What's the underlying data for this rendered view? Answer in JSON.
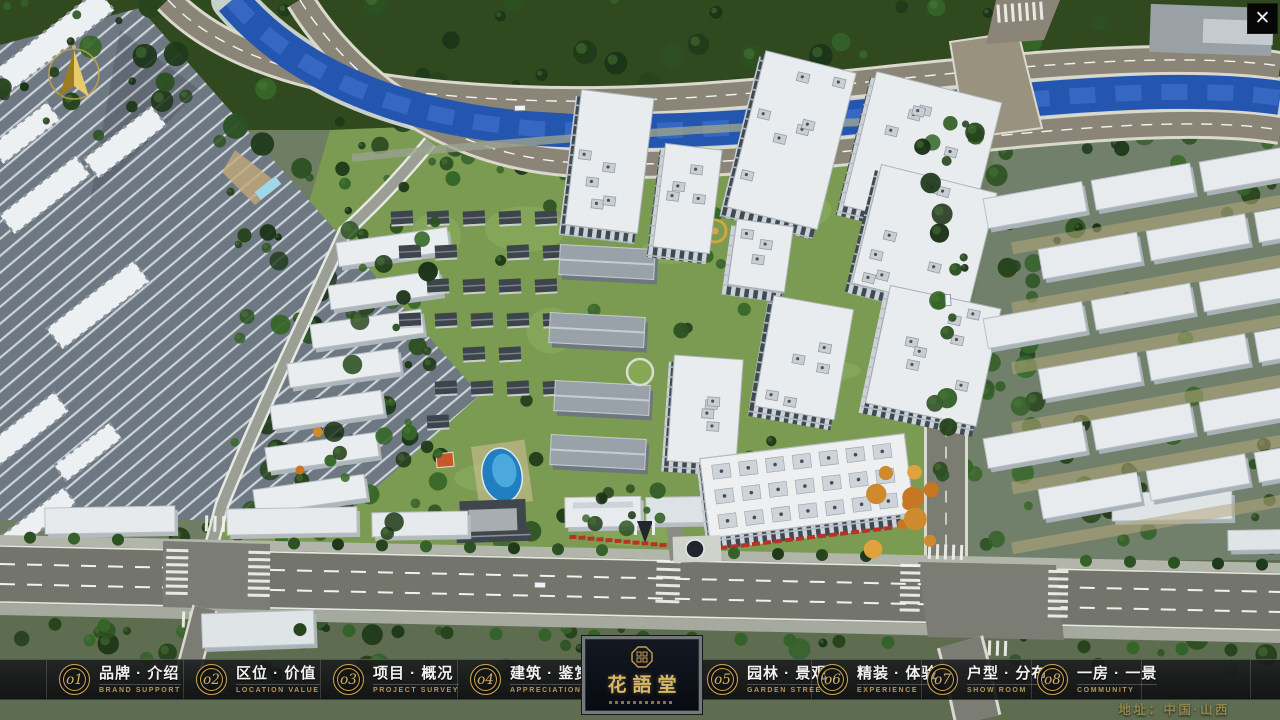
{
  "app": {
    "close_glyph": "✕"
  },
  "icons": {
    "close": "close-icon",
    "compass": "compass-north-arrow-icon",
    "logo_seal": "seal-emblem-icon"
  },
  "nav": {
    "items": [
      {
        "num": "o1",
        "title": "品牌 · 介绍",
        "subtitle": "BRAND SUPPORT"
      },
      {
        "num": "o2",
        "title": "区位 · 价值",
        "subtitle": "LOCATION VALUE"
      },
      {
        "num": "o3",
        "title": "项目 · 概况",
        "subtitle": "PROJECT SURVEY"
      },
      {
        "num": "o4",
        "title": "建筑 · 鉴赏",
        "subtitle": "APPRECIATION"
      },
      {
        "num": "o5",
        "title": "园林 · 景观",
        "subtitle": "GARDEN STREET"
      },
      {
        "num": "o6",
        "title": "精装 · 体验",
        "subtitle": "EXPERIENCE"
      },
      {
        "num": "o7",
        "title": "户型 · 分布",
        "subtitle": "SHOW ROOM"
      },
      {
        "num": "o8",
        "title": "一房 · 一景",
        "subtitle": "COMMUNITY"
      }
    ]
  },
  "logo": {
    "name_cn": "花語堂"
  },
  "footer": {
    "address": "地址：中国·山西"
  },
  "colors": {
    "gold": "#c9a657",
    "bar_background": "rgba(12,13,15,0.85)",
    "title_text": "#f2f2ef",
    "subtitle_text": "#b5985a",
    "river": "#2456b0",
    "road": "#73746c"
  }
}
